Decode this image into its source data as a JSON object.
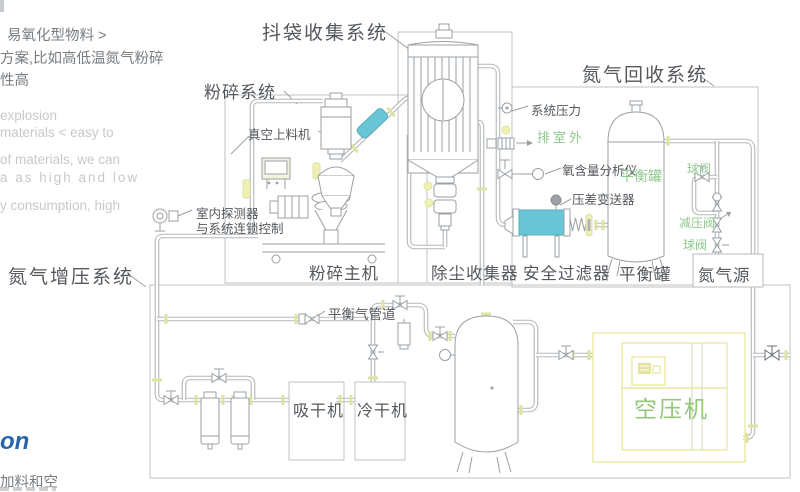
{
  "colors": {
    "dark": "#54585c",
    "gray": "#c6c9cc",
    "mid": "#787d82",
    "green": "#8fc98f",
    "green2": "#93c778",
    "blue": "#2a64a8",
    "pipe": "#b4b8bb",
    "comp": "#9aa0a4",
    "box": "#bcc0c3",
    "cyan": "#68c6d7",
    "yellow": "#eef0b4",
    "ytick": "#dfe3a2",
    "ybox": "#e9e9a6"
  },
  "side_notes": {
    "cn": [
      "易氧化型物料 >",
      "方案,比如高低温氮气粉碎",
      "性高"
    ],
    "en": [
      "explosion",
      "materials < easy to",
      "of materials, we can",
      "a as high and low",
      "y consumption, high"
    ],
    "blue_fragment": "on",
    "bottom_fragment": "加料和空"
  },
  "sections": {
    "bag_shake": "抖袋收集系统",
    "crushing": "粉碎系统",
    "n2_recovery": "氮气回收系统",
    "n2_boost": "氮气增压系统"
  },
  "labels": {
    "vacuum_feeder": "真空上料机",
    "detector_line1": "室内探测器",
    "detector_line2": "与系统连锁控制",
    "system_pressure": "系统压力",
    "vent_outdoor": "排室外",
    "o2_analyzer": "氧含量分析仪",
    "dp_transmitter": "压差变送器",
    "balance_tank_tag": "平衡罐",
    "ball_valve_1": "球阀",
    "reducing_valve": "减压阀",
    "ball_valve_2": "球阀",
    "n2_source": "氮气源",
    "crusher_main": "粉碎主机",
    "dust_collector": "除尘收集器",
    "safety_filter": "安全过滤器",
    "balance_tank": "平衡罐",
    "balance_gas_pipe": "平衡气管道",
    "suction_dryer": "吸干机",
    "cold_dryer": "冷干机",
    "air_compressor": "空压机"
  }
}
